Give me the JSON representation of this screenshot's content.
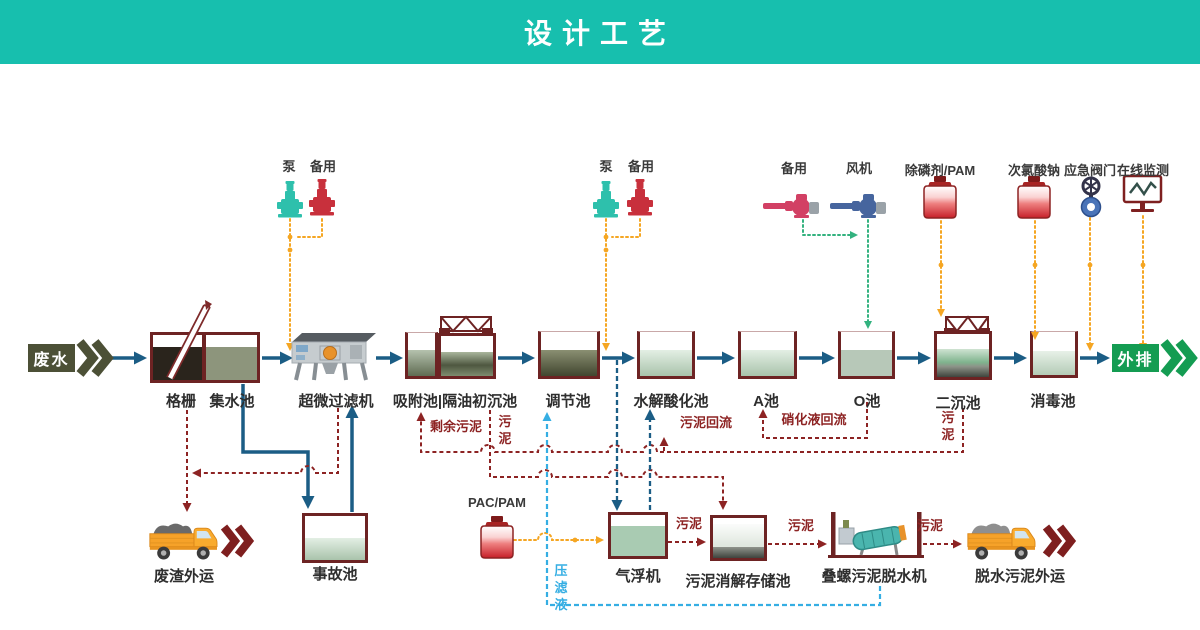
{
  "banner": {
    "title": "设计工艺"
  },
  "io": {
    "inlet": "废水",
    "outlet": "外排"
  },
  "units": {
    "grille": "格栅",
    "collect": "集水池",
    "ultrafilter": "超微过滤机",
    "adsorption": "吸附池|隔油初沉池",
    "regulating": "调节池",
    "hydrolysis": "水解酸化池",
    "tank_a": "A池",
    "tank_o": "O池",
    "clarifier": "二沉池",
    "disinfect": "消毒池",
    "accident": "事故池",
    "flotation": "气浮机",
    "sludge_store": "污泥消解存储池",
    "dewater": "叠螺污泥脱水机"
  },
  "transport": {
    "waste_out": "废渣外运",
    "sludge_out": "脱水污泥外运"
  },
  "dosing": {
    "pump1": "泵",
    "pump1_backup": "备用",
    "pump2": "泵",
    "pump2_backup": "备用",
    "blower_backup": "备用",
    "blower": "风机",
    "phosphorus": "除磷剂/PAM",
    "hypochlorite": "次氯酸钠",
    "valve": "应急阀门",
    "monitor": "在线监测",
    "pac": "PAC/PAM"
  },
  "streams": {
    "excess_sludge": "剩余污泥",
    "sludge_a": "污泥",
    "sludge_return": "污泥回流",
    "nitrate_return": "硝化液回流",
    "sludge_b": "污泥",
    "filtrate": "压滤液",
    "sludge_c": "污泥",
    "sludge_d": "污泥",
    "sludge_e": "污泥"
  },
  "colors": {
    "banner": "#17bfae",
    "pipe": "#1b5d85",
    "sludge_line": "#8d2323",
    "dosing_line": "#f5a623",
    "air_line": "#33b27f",
    "filtrate_line": "#35aee3",
    "inlet_box": "#4c5036",
    "outlet_box": "#149c52"
  }
}
